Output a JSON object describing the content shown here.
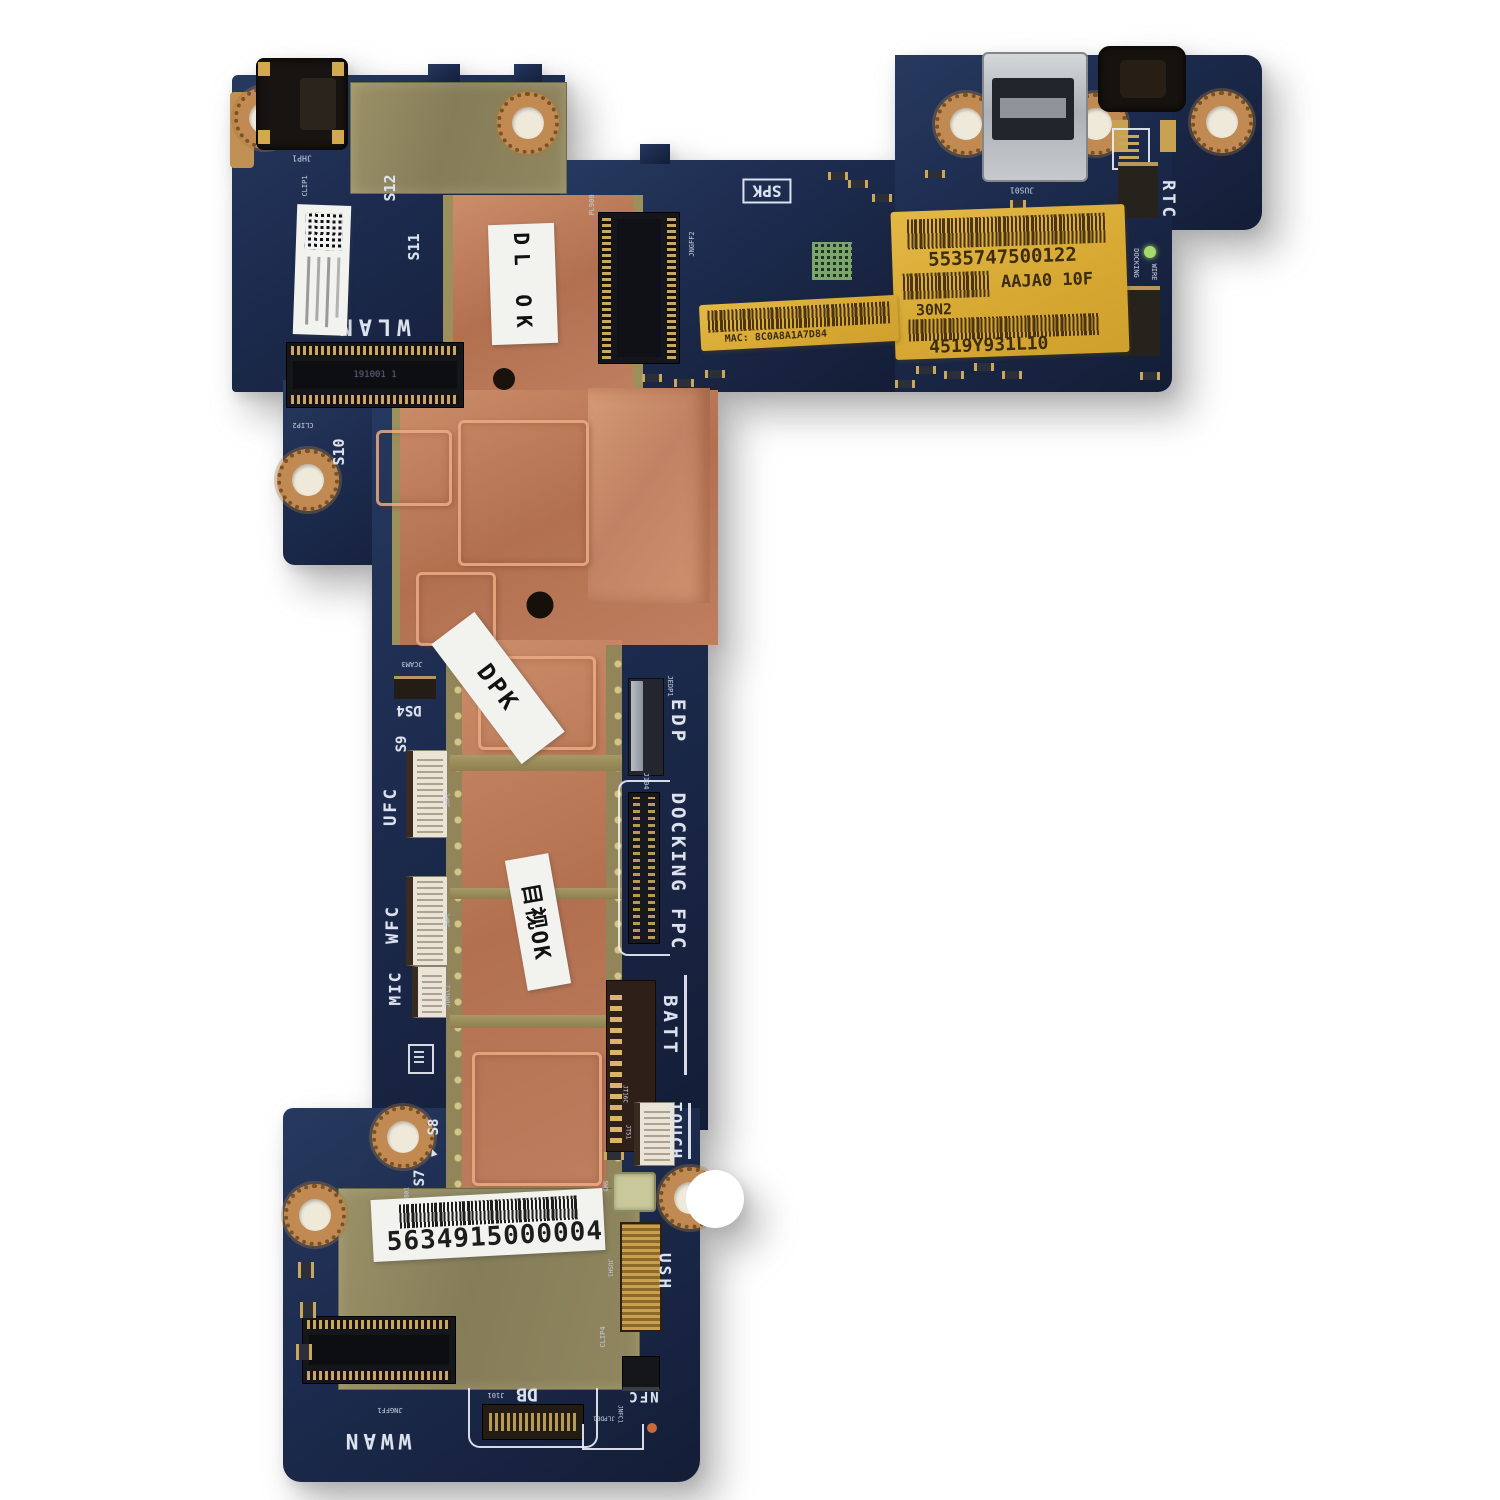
{
  "photo": {
    "subject": "L-shaped tablet motherboard photographed on a white background",
    "background": "#ffffff"
  },
  "colors": {
    "pcb_navy": "#1c2b4e",
    "copper_heatsink": "#bd7d5e",
    "gold_frame": "#9d8f5c",
    "metal_shield": "#8e8660",
    "yellow_sticker": "#d9ab34",
    "silkscreen_white": "#dde3ee"
  },
  "icons": {
    "triangle": "▲"
  },
  "silkscreen": {
    "wlan": "WLAN",
    "wwan": "WWAN",
    "ufc": "UFC",
    "wfc": "WFC",
    "mic": "MIC",
    "edp": "EDP",
    "docking_fpc": "DOCKING FPC",
    "batt": "BATT",
    "touch": "TOUCH",
    "ush": "USH",
    "nfc": "NFC",
    "db": "DB",
    "spk": "SPK",
    "rtc": "RTC",
    "docking": "DOCKING",
    "wire": "WIRE",
    "s7": "S7",
    "s8": "S8",
    "s9": "S9",
    "s10": "S10",
    "s11": "S11",
    "s12": "S12",
    "ds4": "DS4",
    "jcam3": "JCAM3",
    "jhp1": "JHP1",
    "clip1": "CLIP1",
    "clip2": "CLIP2",
    "clip4": "CLIP4",
    "jngff1": "JNGFF1",
    "jngff2": "JNGFF2",
    "jngff3": "JNGFF3",
    "jus01": "JUS01",
    "j101": "J101",
    "j104": "J104",
    "jedp1": "JEDP1",
    "jlpde1": "JLPDE1",
    "jt51": "JT51",
    "jt16c": "JT16C",
    "jufc": "JUFC",
    "jwfc": "JWFC",
    "jdmic1": "JDMIC1",
    "jush1": "JUSH1",
    "jnfc1": "JNFC1",
    "pjp801": "PJP801",
    "pl900": "PL900",
    "sw3": "SW3",
    "slot_print": "191001 1"
  },
  "stickers": {
    "yellow_label": {
      "line1": "5535747500122",
      "line2": "AAJA0 10F",
      "line3": "30N2",
      "line4": "4519Y931L10"
    },
    "mac_label": "MAC: 8C0A8A1A7D84",
    "serial_label": "5634915000004",
    "dl_ok_label": "DL OK",
    "dpk_label": "DPK",
    "visual_ok_label": "目视OK"
  }
}
